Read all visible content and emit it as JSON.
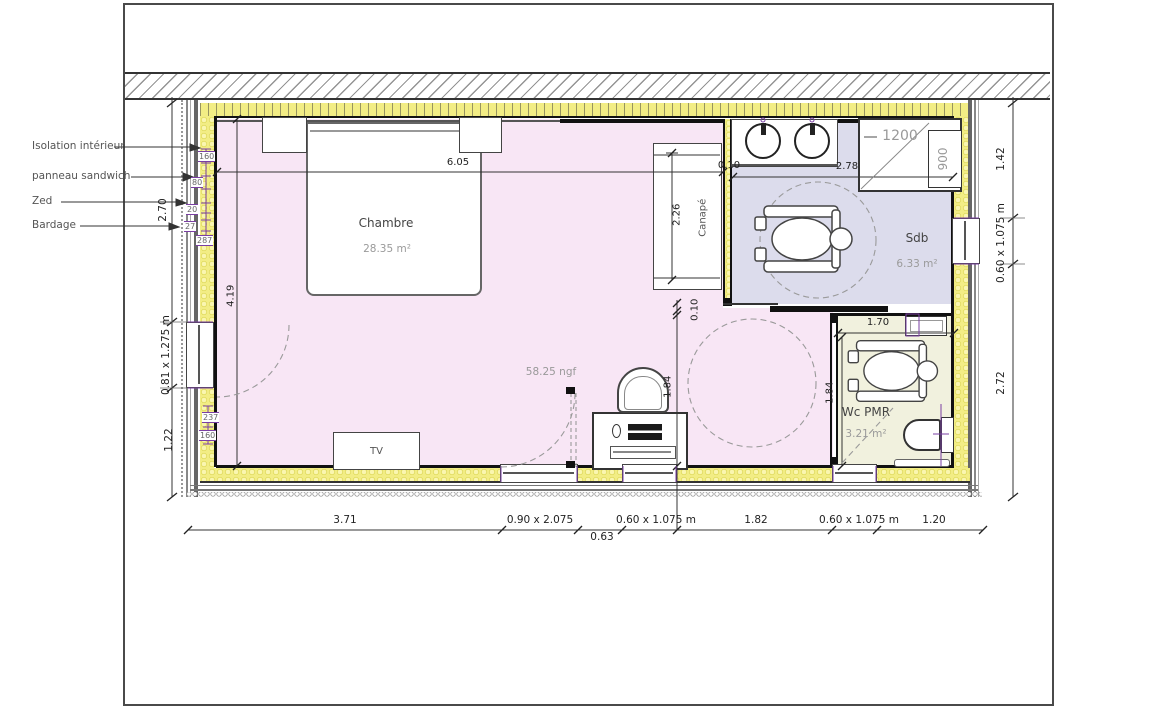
{
  "legend": {
    "isolation": "Isolation intérieur",
    "panneau": "panneau sandwich",
    "zed": "Zed",
    "bardage": "Bardage"
  },
  "rooms": {
    "chambre": {
      "name": "Chambre",
      "area": "28.35 m²"
    },
    "sdb": {
      "name": "Sdb",
      "area": "6.33 m²"
    },
    "wc": {
      "name": "Wc PMR",
      "area": "3.21 m²"
    }
  },
  "furniture": {
    "tv": "TV",
    "canape": "Canapé"
  },
  "notes": {
    "level": "58.25 ngf",
    "shower_width": "1200",
    "shower_depth": "900"
  },
  "dims": {
    "left": {
      "upper": "2.70",
      "window": "0.81 x 1.275 m",
      "lower": "1.22"
    },
    "right": {
      "upper": "1.42",
      "window": "0.60 x 1.075 m",
      "lower": "2.72"
    },
    "bottom": {
      "seg1": "3.71",
      "door": "0.90 x 2.075",
      "sub": "0.63",
      "win1": "0.60 x 1.075 m",
      "seg2": "1.82",
      "win2": "0.60 x 1.075 m",
      "seg3": "1.20"
    },
    "interior": {
      "room_width": "6.05",
      "room_height": "4.19",
      "canape": "2.26",
      "partition": "0.10",
      "sdb_width": "2.78",
      "slide_wall": "0.10",
      "wc_door": "1.70",
      "hall": "1.84",
      "wc": "1.84"
    },
    "layers": {
      "insulation": "160",
      "panel": "80",
      "zed": "20",
      "bardage": "27",
      "total": "287",
      "lower_a": "237",
      "lower_b": "160"
    }
  },
  "colors": {
    "room_pink": "#f8e6f5",
    "room_lavender": "#dcdcec",
    "room_cream": "#f1f1de",
    "insulation_yellow": "#f2ed85",
    "dimension_purple": "#7a3fa3"
  }
}
